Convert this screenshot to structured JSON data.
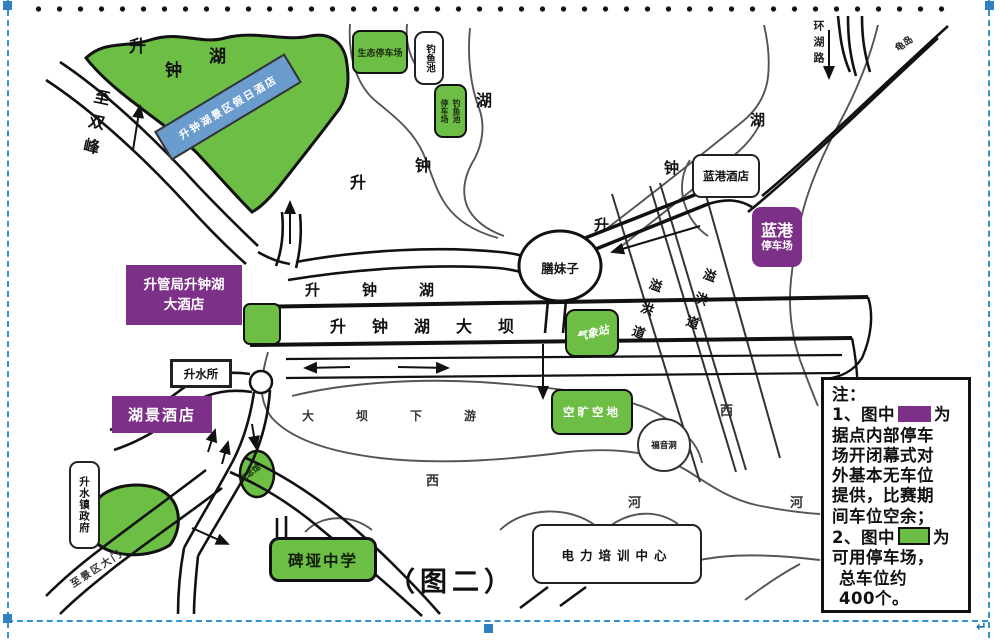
{
  "caption": "（图二）",
  "colors": {
    "parking_purple": "#7d3087",
    "available_green": "#6cbe45",
    "hotel_blue": "#6b9cce",
    "selection_blue": "#2f93d6"
  },
  "places": {
    "holiday_hotel": "升钟湖景区假日酒店",
    "eco_parking": "生态停车场",
    "fishing_pond": "钓鱼池",
    "fishpond_parking_right": "钓鱼池",
    "fishpond_parking_left": "停车场",
    "blue_harbor_hotel": "蓝港酒店",
    "blue_harbor_parking_name": "蓝港",
    "blue_harbor_parking_type": "停车场",
    "shan_mei_zi": "膳妹子",
    "weather_station": "气象站",
    "mgmt_hotel_line1": "升管局升钟湖",
    "mgmt_hotel_line2": "大酒店",
    "sheng_shui_office": "升水所",
    "lake_view_hotel": "湖景酒店",
    "memorial_hall": "纪念馆",
    "town_government": "升水镇政府",
    "open_space": "空旷空地",
    "fuyin_cave": "福音洞",
    "beiya_school": "碑垭中学",
    "power_training_center": "电力培训中心"
  },
  "geo": {
    "lake_top": [
      "升",
      "钟",
      "湖"
    ],
    "lake_mid": [
      "升",
      "钟",
      "湖"
    ],
    "lake_right": [
      "升",
      "钟",
      "湖"
    ],
    "lake_row": "升钟湖",
    "dam": "升钟湖大坝",
    "downstream": "大坝下游",
    "spillway1": "溢洪道",
    "spillway2": "溢洪道",
    "west1": "西",
    "river1": "河",
    "west2": "西",
    "river2": "河",
    "to_shuangfeng": "至双峰",
    "to_scenic_gate": "至景区大门",
    "ring_road": "环湖路",
    "turtle_island": "龟岛"
  },
  "note": {
    "heading": "注：",
    "item1_prefix": "1、图中",
    "item1_suffix": "为",
    "item1_lines": [
      "据点内部停车",
      "场开闭幕式对",
      "外基本无车位",
      "提供，比赛期",
      "间车位空余；"
    ],
    "item2_prefix": "2、图中",
    "item2_suffix": "为",
    "item2_lines": [
      "可用停车场，",
      "总车位约",
      "400个。"
    ]
  }
}
